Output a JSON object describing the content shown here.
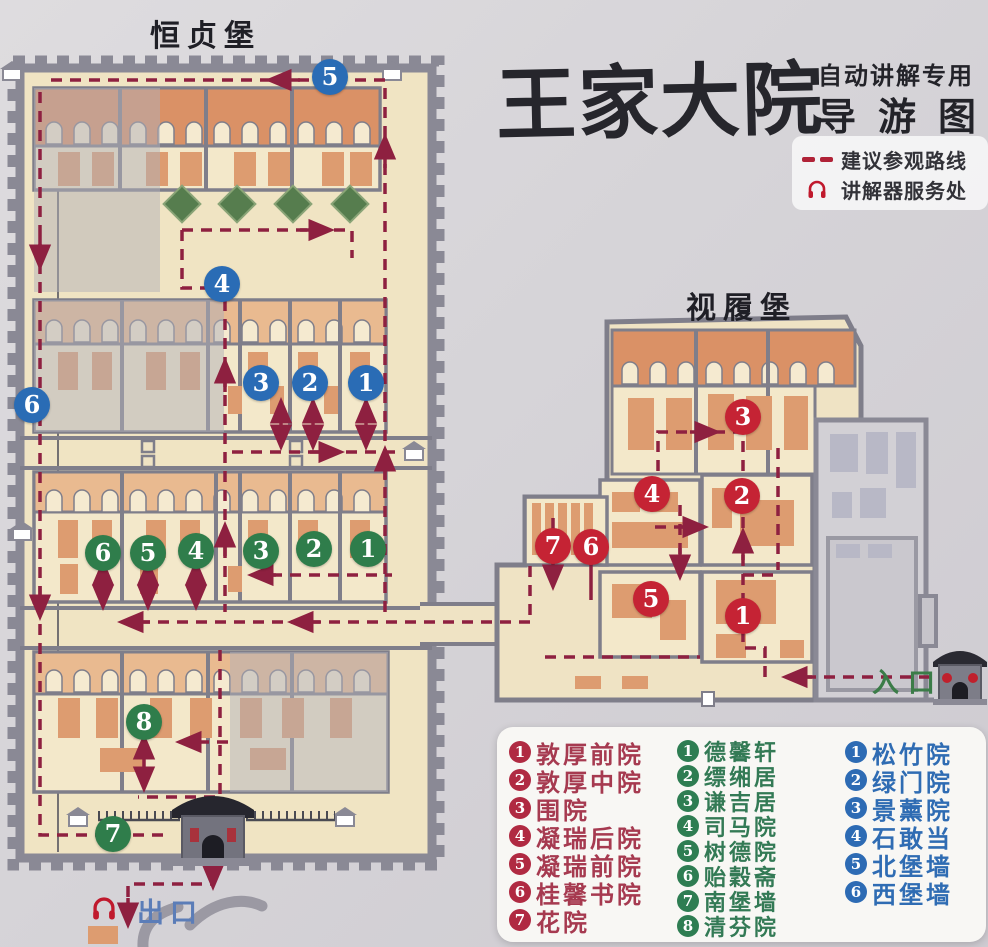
{
  "title": {
    "main": "王家大院",
    "sub_top": "自动讲解专用",
    "sub_bottom": "导游图"
  },
  "key": {
    "route_label": "建议参观路线",
    "audio_label": "讲解器服务处"
  },
  "fort_labels": {
    "hengzhen": "恒贞堡",
    "shilv": "视履堡"
  },
  "poi": {
    "entrance": "入口",
    "exit": "出口"
  },
  "markers": {
    "blue": [
      "5",
      "4",
      "6",
      "3",
      "2",
      "1"
    ],
    "green": [
      "6",
      "5",
      "4",
      "3",
      "2",
      "1",
      "8",
      "7"
    ],
    "red": [
      "3",
      "4",
      "2",
      "7",
      "6",
      "5",
      "1"
    ]
  },
  "legend": {
    "red": [
      {
        "num": "1",
        "name": "敦厚前院"
      },
      {
        "num": "2",
        "name": "敦厚中院"
      },
      {
        "num": "3",
        "name": "围院"
      },
      {
        "num": "4",
        "name": "凝瑞后院"
      },
      {
        "num": "5",
        "name": "凝瑞前院"
      },
      {
        "num": "6",
        "name": "桂馨书院"
      },
      {
        "num": "7",
        "name": "花院"
      }
    ],
    "green": [
      {
        "num": "1",
        "name": "德馨轩"
      },
      {
        "num": "2",
        "name": "缥缃居"
      },
      {
        "num": "3",
        "name": "谦吉居"
      },
      {
        "num": "4",
        "name": "司马院"
      },
      {
        "num": "5",
        "name": "树德院"
      },
      {
        "num": "6",
        "name": "贻穀斋"
      },
      {
        "num": "7",
        "name": "南堡墙"
      },
      {
        "num": "8",
        "name": "清芬院"
      }
    ],
    "blue": [
      {
        "num": "1",
        "name": "松竹院"
      },
      {
        "num": "2",
        "name": "绿门院"
      },
      {
        "num": "3",
        "name": "景薰院"
      },
      {
        "num": "4",
        "name": "石敢当"
      },
      {
        "num": "5",
        "name": "北堡墙"
      },
      {
        "num": "6",
        "name": "西堡墙"
      }
    ]
  },
  "colors": {
    "route": "#8e2040",
    "marker_blue": "#2a6cb5",
    "marker_green": "#2f7d4b",
    "marker_red": "#c52334",
    "wall_grey": "#8a8995",
    "ground_cream": "#f0e4c3",
    "roof_orange": "#da9166"
  }
}
